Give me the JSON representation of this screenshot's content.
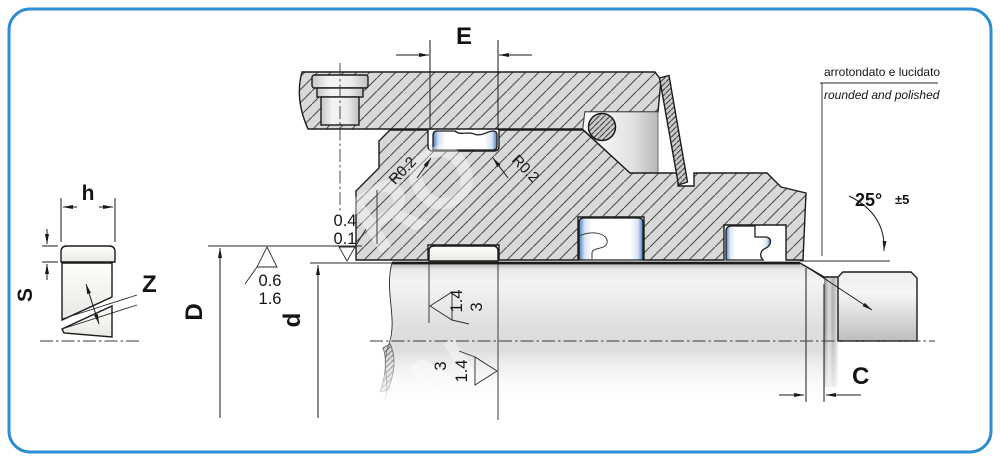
{
  "dimensions": {
    "groove_width": "E",
    "ring_height": "h",
    "ring_thickness": "S",
    "cut_angle": "Z",
    "outer_diameter": "D",
    "shaft_diameter": "d",
    "chamfer_length": "C"
  },
  "radii": {
    "left": "R0.2",
    "right": "R0.2"
  },
  "chamfer_angle": {
    "value": "25°",
    "tolerance": "±5"
  },
  "surface_finish": {
    "clearance": {
      "line1": "0.4",
      "line2": "0.1"
    },
    "groove_bore": {
      "line1": "0.6",
      "line2": "1.6"
    },
    "shaft_upper": {
      "near": "1.4",
      "far": "3"
    },
    "shaft_lower": {
      "near": "1.4",
      "far": "3"
    }
  },
  "notes": {
    "italian": "arrotondato e lucidato",
    "english": "rounded and polished"
  },
  "watermark": {
    "fragment1": "RO",
    "fragment2": "N"
  },
  "colors": {
    "border": "#2d8ed3",
    "seal_shading": "#4d7cc0",
    "hatch_fill": "#d9d9d9",
    "line": "#1c1c1c"
  }
}
